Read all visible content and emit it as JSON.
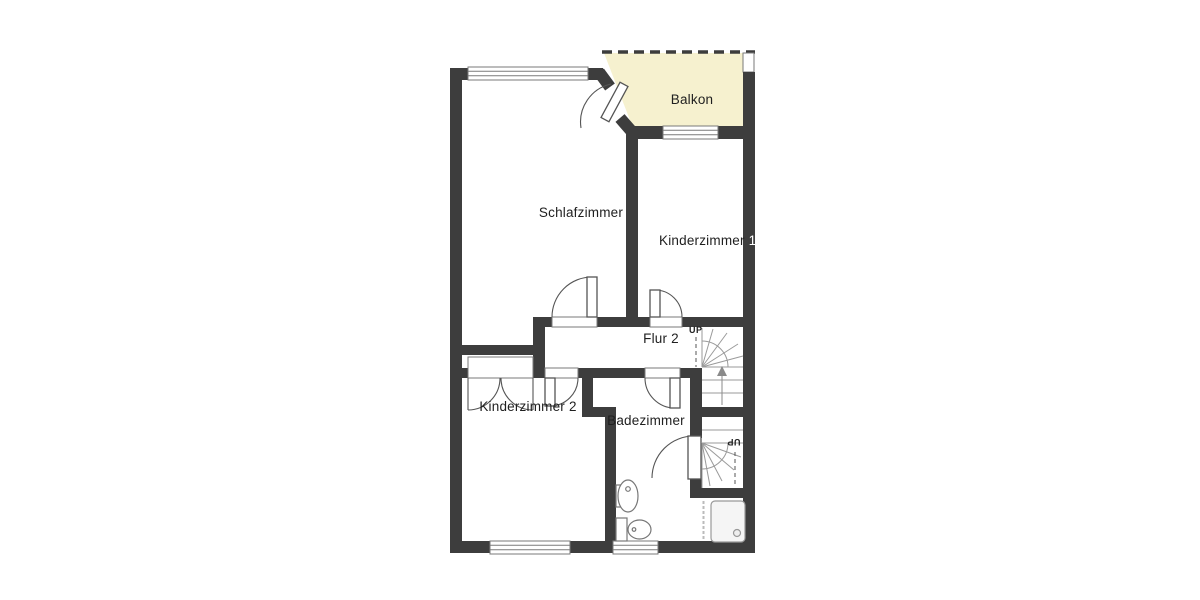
{
  "plan": {
    "type": "floor-plan",
    "floor_hint": "upper floor of a dwelling",
    "colors": {
      "wall": "#3d3d3d",
      "balcony_fill": "#f6f1cf",
      "symbol_border": "#7a7a7a",
      "door_line": "#555555",
      "stair_line": "#9a9a9a",
      "fixture_border": "#777777",
      "text": "#1f1f1f",
      "background": "#ffffff"
    },
    "rooms": {
      "balkon": {
        "label": "Balkon"
      },
      "schlafzimmer": {
        "label": "Schlafzimmer"
      },
      "kinderzimmer1": {
        "label": "Kinderzimmer",
        "number": "1"
      },
      "flur2": {
        "label": "Flur 2"
      },
      "kinderzimmer2": {
        "label": "Kinderzimmer 2"
      },
      "badezimmer": {
        "label": "Badezimmer"
      }
    },
    "stairs": {
      "upper": {
        "label": "UP",
        "direction": "up"
      },
      "lower": {
        "label": "UP",
        "direction": "up-from-below",
        "rotated": true
      }
    },
    "fixtures": [
      "sink",
      "toilet",
      "shower"
    ],
    "openings": {
      "windows": 5,
      "doors": [
        "balcony-door",
        "schlafzimmer-door",
        "kinderzimmer1-door",
        "kinderzimmer2-door",
        "badezimmer-door",
        "stair-landing-door",
        "closet-double-door"
      ]
    }
  }
}
